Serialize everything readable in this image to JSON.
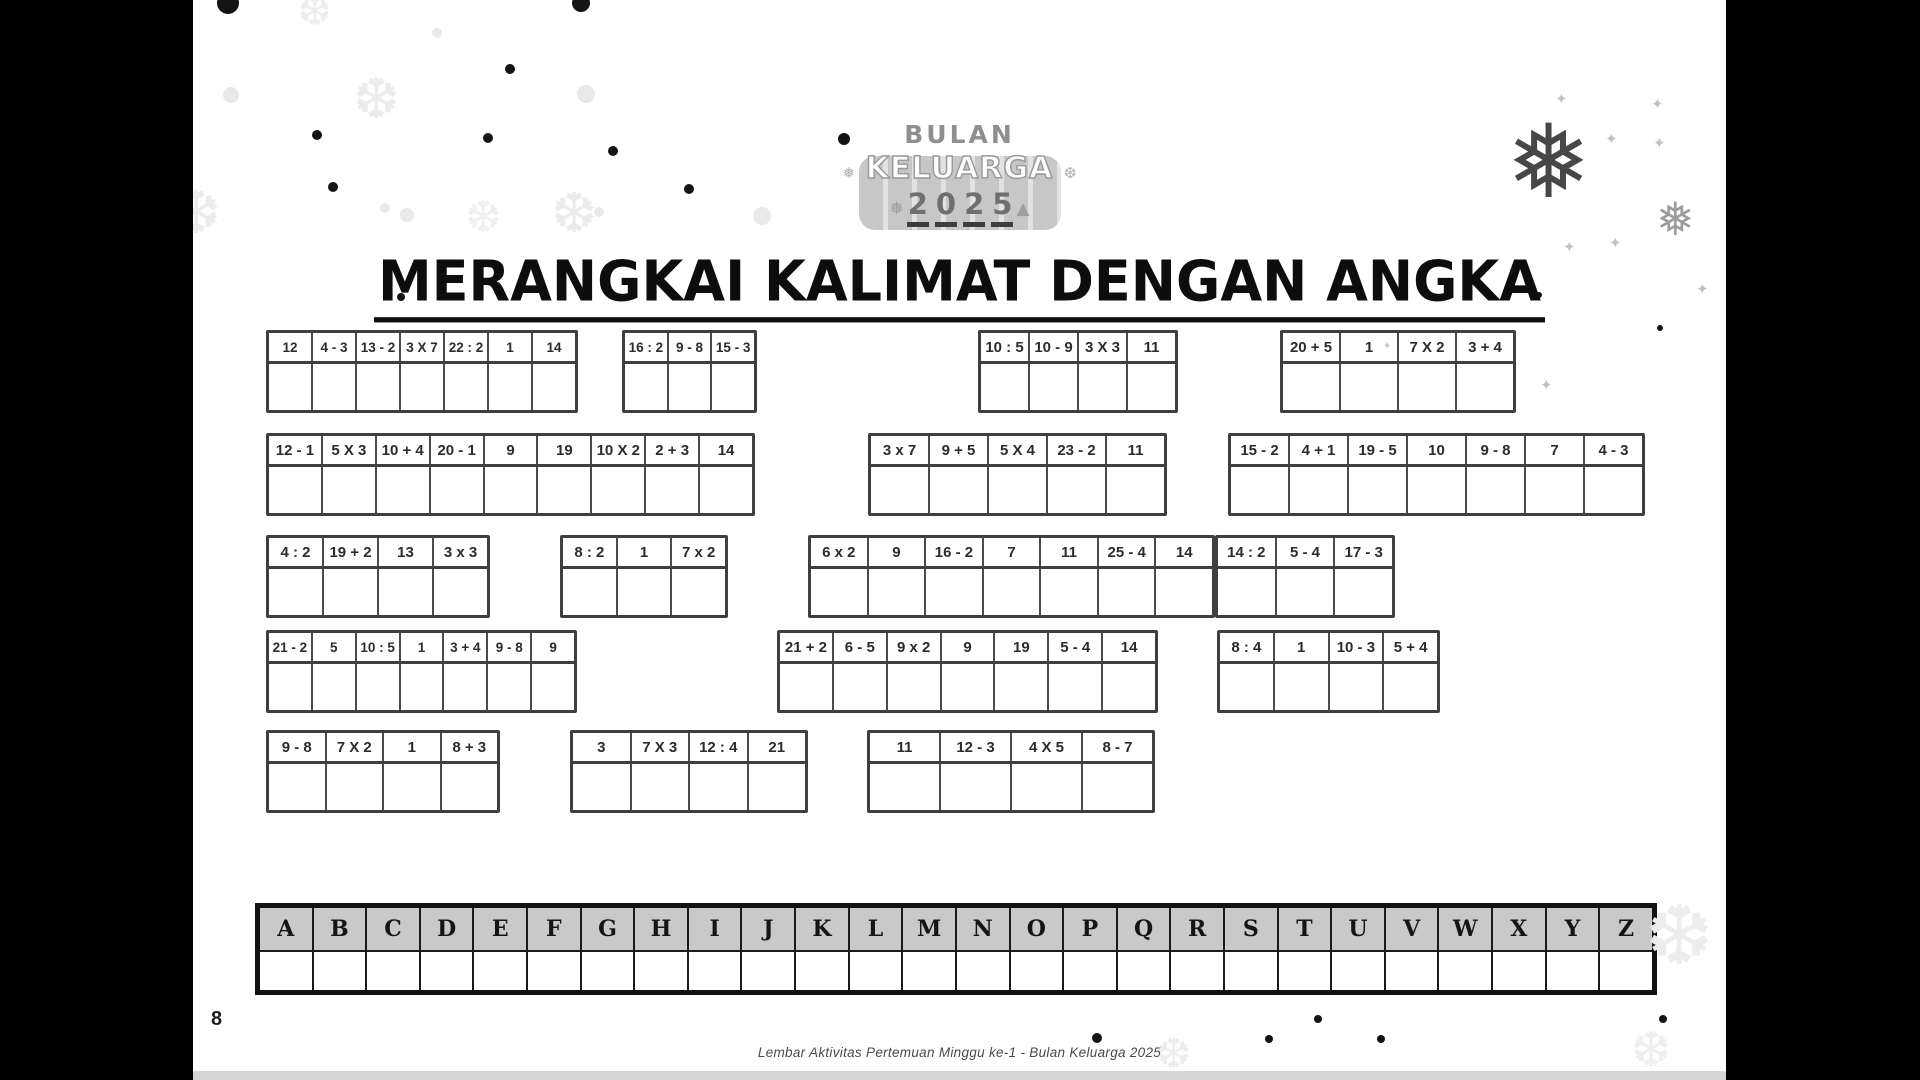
{
  "page": {
    "number": "8",
    "footer": "Lembar Aktivitas Pertemuan Minggu ke-1 - Bulan Keluarga 2025"
  },
  "logo": {
    "top": "BULAN",
    "middle": "KELUARGA",
    "bottom": "2025"
  },
  "title": "MERANGKAI KALIMAT DENGAN ANGKA",
  "alphabet": [
    "A",
    "B",
    "C",
    "D",
    "E",
    "F",
    "G",
    "H",
    "I",
    "J",
    "K",
    "L",
    "M",
    "N",
    "O",
    "P",
    "Q",
    "R",
    "S",
    "T",
    "U",
    "V",
    "W",
    "X",
    "Y",
    "Z"
  ],
  "puzzle": {
    "r1g1": [
      "12",
      "4 - 3",
      "13 - 2",
      "3 X 7",
      "22 : 2",
      "1",
      "14"
    ],
    "r1g2": [
      "16 : 2",
      "9 - 8",
      "15 - 3"
    ],
    "r1g3": [
      "10 : 5",
      "10 - 9",
      "3 X 3",
      "11"
    ],
    "r1g4": [
      "20 + 5",
      "1",
      "7 X 2",
      "3 + 4"
    ],
    "r2g1": [
      "12 - 1",
      "5 X 3",
      "10 + 4",
      "20 - 1",
      "9",
      "19",
      "10 X 2",
      "2 + 3",
      "14"
    ],
    "r2g2": [
      "3 x 7",
      "9 + 5",
      "5 X 4",
      "23 - 2",
      "11"
    ],
    "r2g3": [
      "15 - 2",
      "4 + 1",
      "19 - 5",
      "10",
      "9 - 8",
      "7",
      "4 - 3"
    ],
    "r3g1": [
      "4 : 2",
      "19 + 2",
      "13",
      "3 x 3"
    ],
    "r3g2": [
      "8 : 2",
      "1",
      "7 x 2"
    ],
    "r3g3": [
      "6 x 2",
      "9",
      "16 - 2",
      "7",
      "11",
      "25 - 4",
      "14"
    ],
    "r3g4": [
      "14 : 2",
      "5 - 4",
      "17 - 3"
    ],
    "r4g1": [
      "21 - 2",
      "5",
      "10 : 5",
      "1",
      "3 + 4",
      "9 - 8",
      "9"
    ],
    "r4g2": [
      "21 + 2",
      "6 - 5",
      "9 x 2",
      "9",
      "19",
      "5 - 4",
      "14"
    ],
    "r4g3": [
      "8 : 4",
      "1",
      "10 - 3",
      "5 + 4"
    ],
    "r5g1": [
      "9 - 8",
      "7 X 2",
      "1",
      "8 + 3"
    ],
    "r5g2": [
      "3",
      "7 X 3",
      "12 : 4",
      "21"
    ],
    "r5g3": [
      "11",
      "12 - 3",
      "4 X 5",
      "8 - 7"
    ]
  },
  "icons": {
    "snowflake": "❅",
    "snowflake_outline": "❆",
    "sparkle": "✦"
  }
}
